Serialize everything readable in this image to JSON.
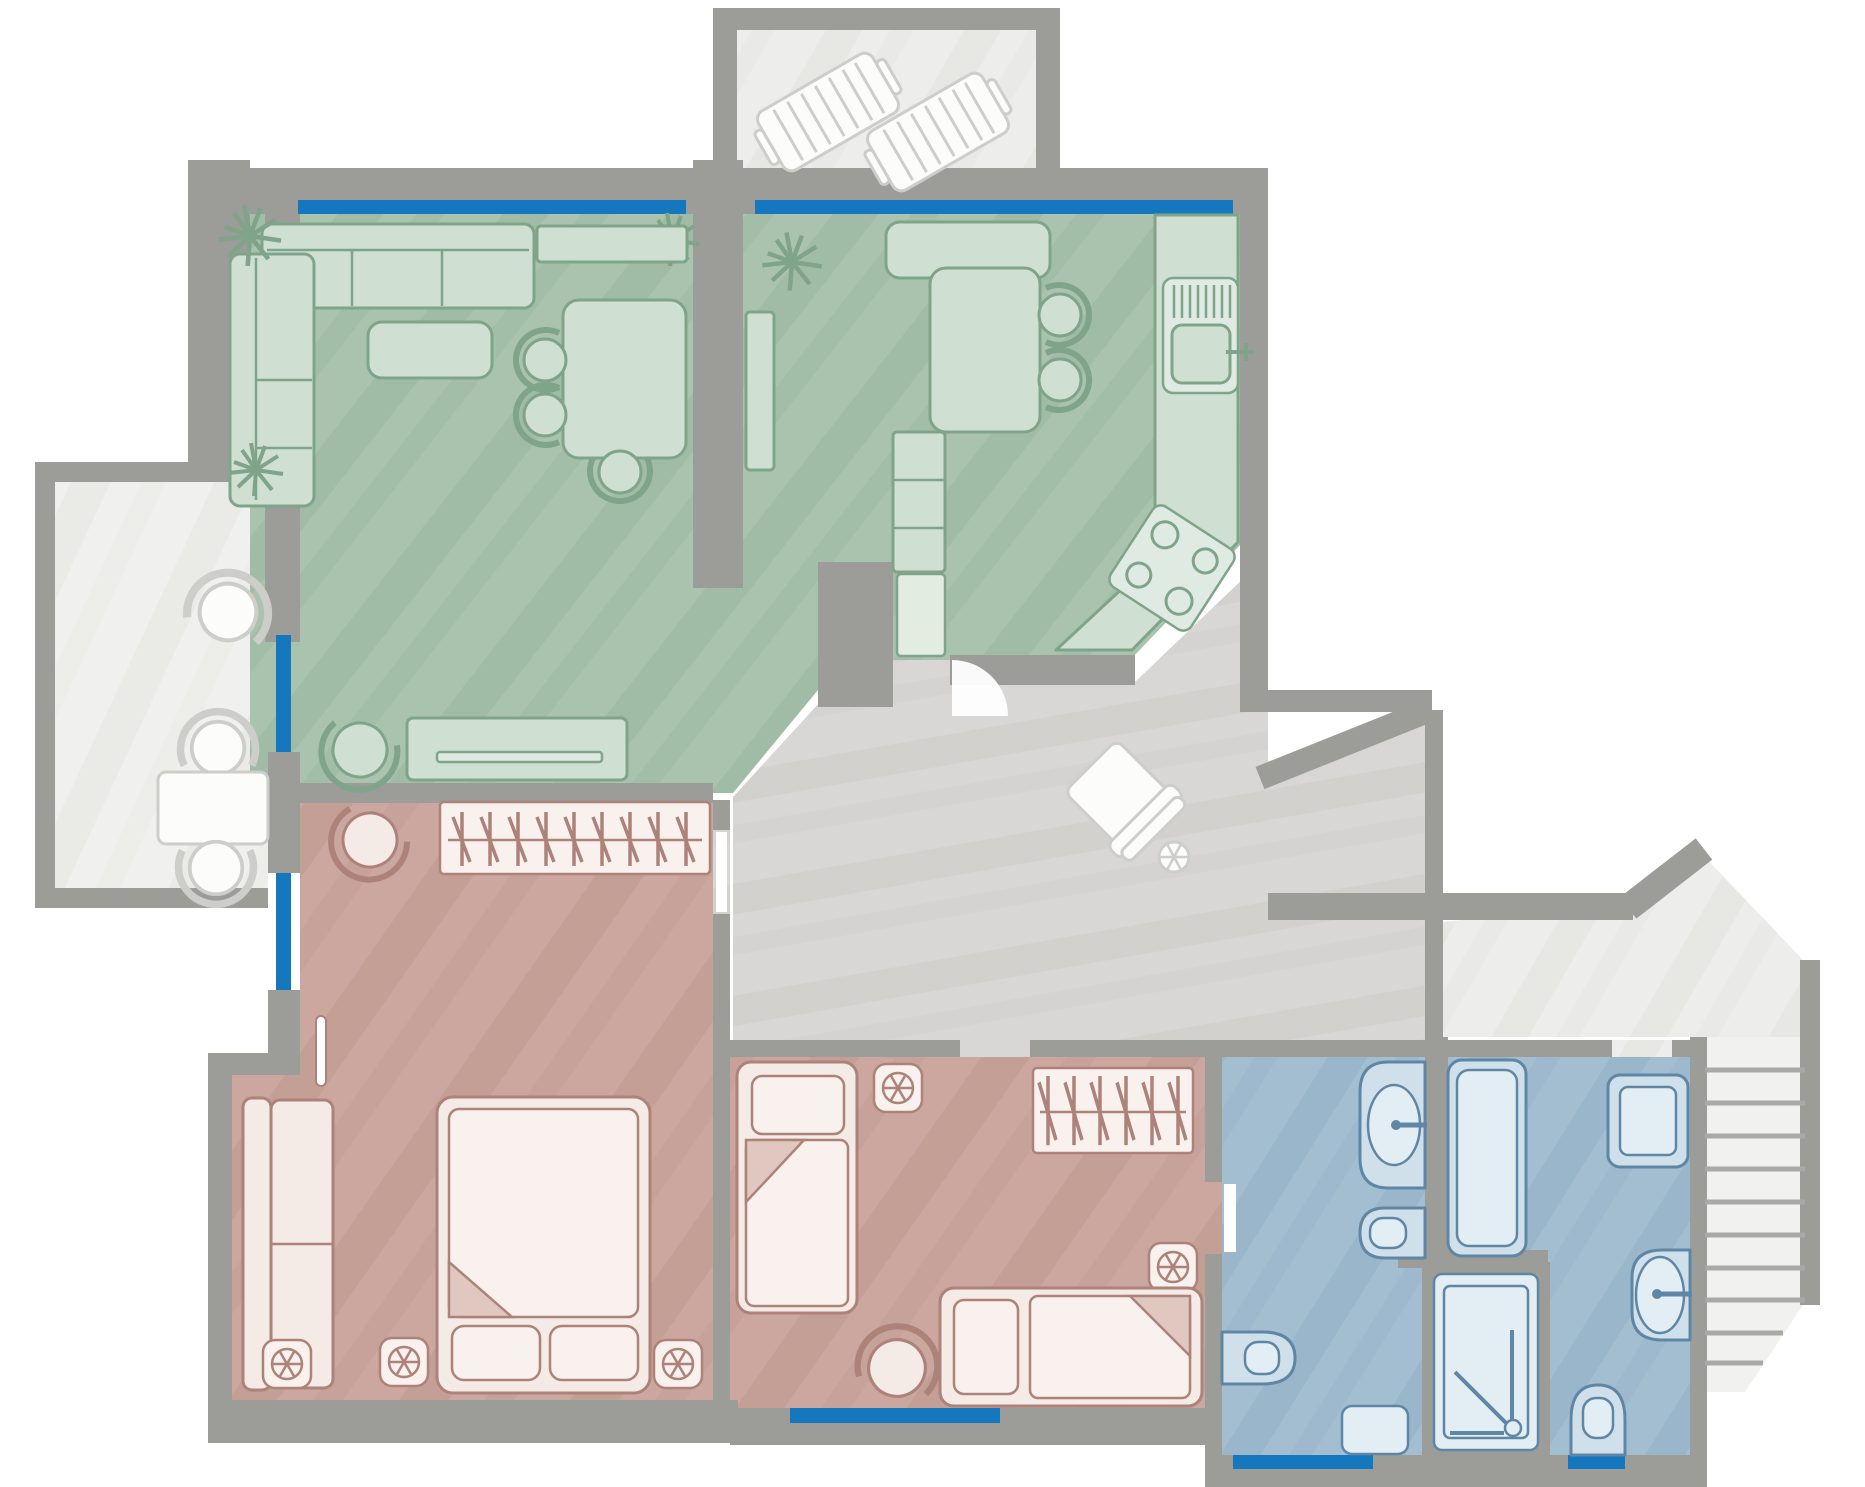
{
  "title": "Apartment floor plan (top view)",
  "palette": {
    "wall": "#9c9c98",
    "window": "#1577bd",
    "outside": "#ffffff",
    "hall": "#d8d7d5",
    "hall_streak": "#cccbc8",
    "terrace": "#ededeb",
    "terrace_streak": "#e2e2df",
    "balcony": "#f0f0ee",
    "balcony_streak": "#e6e6e3",
    "living": "#a9c3ae",
    "living_streak": "#97b59d",
    "bedroom": "#cba79f",
    "bedroom_streak": "#bc948c",
    "bath": "#a3bdd1",
    "bath_streak": "#92afc5",
    "furn_green": "#cfe0d3",
    "stroke_green": "#7fa489",
    "furn_pink": "#f4eae6",
    "stroke_pink": "#ad8279",
    "furn_blue": "#cfe0ea",
    "stroke_blue": "#5f87a5",
    "furn_white": "#fcfcfb",
    "stroke_light": "#cdcdc9",
    "stair": "#f1f1ef",
    "stair_line": "#a9a9a5"
  },
  "rooms": [
    {
      "id": "living-room",
      "zone": "green",
      "furniture": [
        "corner-sofa",
        "coffee-table",
        "dining-table",
        "dining-chairs-x3",
        "sideboard",
        "tv-unit",
        "pouf",
        "plants-x2"
      ]
    },
    {
      "id": "kitchen",
      "zone": "green",
      "furniture": [
        "bar-counter",
        "bar-table",
        "bar-stools-x2",
        "tall-cabinet",
        "base-cabinets",
        "sink-unit",
        "stove-4-burners",
        "plant"
      ]
    },
    {
      "id": "hallway",
      "zone": "gray",
      "furniture": [
        "armchair-rotated",
        "vent-fan",
        "door-swing-arc"
      ]
    },
    {
      "id": "master-bedroom",
      "zone": "pink",
      "furniture": [
        "double-bed",
        "pillows-x2",
        "open-wardrobe-hangers",
        "bench-sofa",
        "pouf",
        "floor-vents-x3",
        "radiator"
      ]
    },
    {
      "id": "bedroom-2",
      "zone": "pink",
      "furniture": [
        "single-bed-vertical",
        "single-bed-horizontal",
        "open-wardrobe-hangers",
        "stool",
        "floor-vents-x2"
      ]
    },
    {
      "id": "bathroom-1",
      "zone": "blue",
      "furniture": [
        "washbasin",
        "toilet",
        "bidet",
        "bath-mat",
        "door-leaf"
      ]
    },
    {
      "id": "shower-cabin",
      "zone": "blue",
      "furniture": [
        "shower-tray",
        "hand-shower"
      ]
    },
    {
      "id": "bathroom-2",
      "zone": "blue",
      "furniture": [
        "bathtub",
        "washing-machine",
        "washbasin",
        "toilet"
      ]
    },
    {
      "id": "balcony-left",
      "zone": "outdoor",
      "furniture": [
        "round-chair",
        "cafe-table",
        "chairs-x2"
      ]
    },
    {
      "id": "balcony-top",
      "zone": "outdoor",
      "furniture": [
        "sun-lounger",
        "sun-lounger"
      ]
    },
    {
      "id": "terrace-right",
      "zone": "outdoor",
      "furniture": []
    },
    {
      "id": "staircase",
      "zone": "outdoor",
      "furniture": [
        "steps"
      ]
    }
  ],
  "windows": {
    "count": 7,
    "color": "#1577bd",
    "locations": [
      "living-top",
      "kitchen-top",
      "living-left",
      "master-left",
      "bedroom2-bottom",
      "bathroom1-bottom",
      "bathroom2-bottom"
    ]
  },
  "doors": [
    "kitchen-to-hall",
    "master-bedroom",
    "bedroom-2",
    "bathroom-1",
    "bathroom-2-terrace"
  ]
}
